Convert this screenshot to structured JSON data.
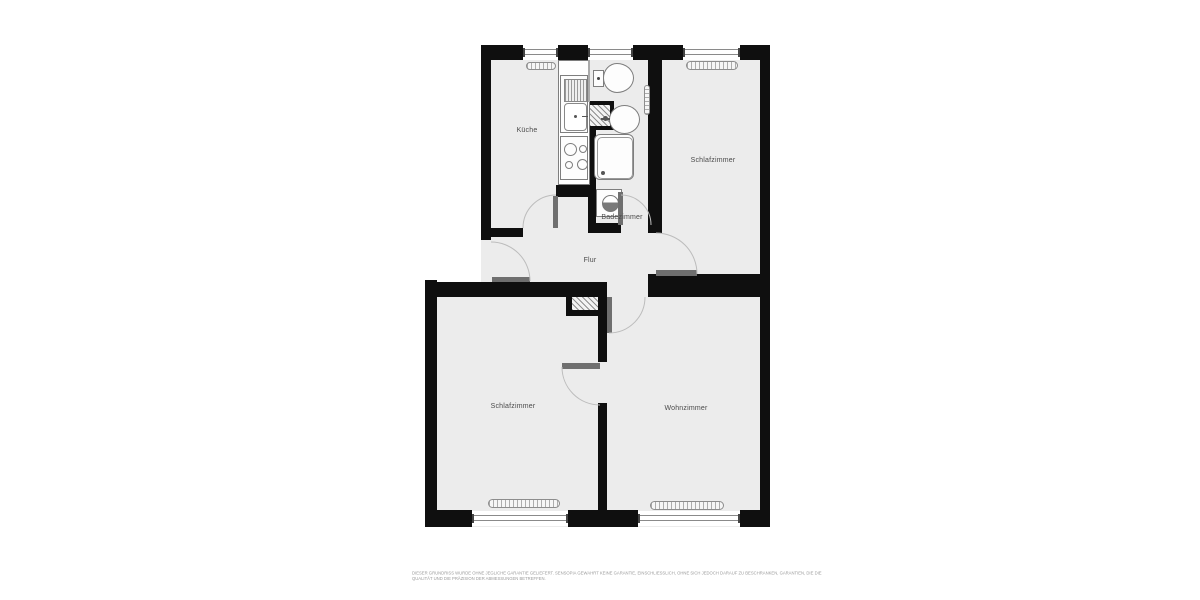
{
  "plan": {
    "rooms": [
      {
        "id": "kueche",
        "label": "Küche"
      },
      {
        "id": "schlafzimmer-top",
        "label": "Schlafzimmer"
      },
      {
        "id": "badezimmer",
        "label": "Badezimmer"
      },
      {
        "id": "flur",
        "label": "Flur"
      },
      {
        "id": "schlafzimmer-bottom",
        "label": "Schlafzimmer"
      },
      {
        "id": "wohnzimmer",
        "label": "Wohnzimmer"
      }
    ],
    "disclaimer": {
      "line1": "DIESER GRUNDRISS WURDE OHNE JEGLICHE GARANTIE GELIEFERT. SENSOPIA GEWÄHRT KEINE GARANTIE, EINSCHLIESSLICH, OHNE SICH JEDOCH DARAUF ZU BESCHRÄNKEN, GARANTIEN, DIE DIE",
      "line2": "QUALITÄT UND DIE PRÄZISION DER ABMESSUNGEN BETREFFEN."
    },
    "colors": {
      "wall": "#0f0f0f",
      "room_fill": "#ececec",
      "door_leaf": "#6f6f6f",
      "arc": "#bcbcbc",
      "label": "#4a4a4a",
      "disclaimer": "#9b9b9b"
    }
  }
}
